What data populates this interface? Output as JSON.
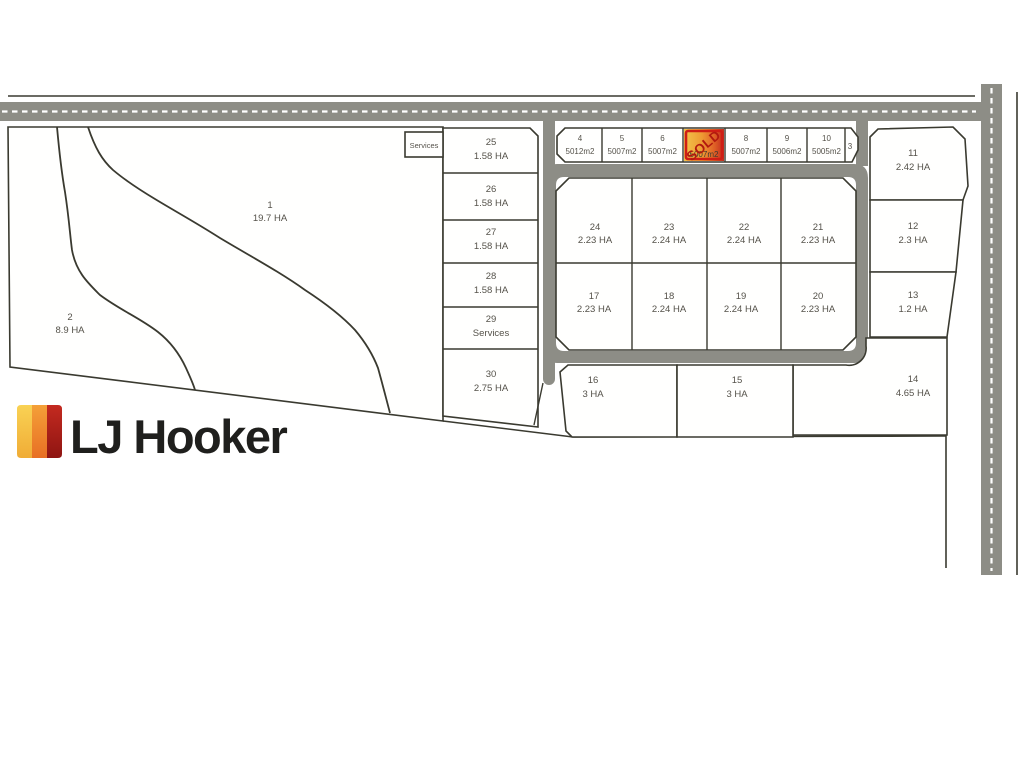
{
  "plan": {
    "title_context": "LJ Hooker land subdivision plan",
    "logo": {
      "text": "LJ Hooker"
    },
    "services_box_label": "Services",
    "sold_label": "SOLD",
    "colors": {
      "road": "#8d8d86",
      "lot_outline": "#3a3a30",
      "label_text": "#55524a",
      "sold_border": "#cf1d15",
      "sold_text": "#b2190f",
      "sold_gradient": [
        "#f2c44a",
        "#ee9a33",
        "#e06226",
        "#c22b1d"
      ],
      "logo_stripes": [
        "#f8c94b",
        "#f09130",
        "#b5211b"
      ],
      "logo_text": "#1f1f1d"
    },
    "lots": {
      "l1": {
        "num": "1",
        "area": "19.7 HA"
      },
      "l2": {
        "num": "2",
        "area": "8.9 HA"
      },
      "l3": {
        "num": "3",
        "area": ""
      },
      "l4": {
        "num": "4",
        "area": "5012m2"
      },
      "l5": {
        "num": "5",
        "area": "5007m2"
      },
      "l6": {
        "num": "6",
        "area": "5007m2"
      },
      "l7": {
        "num": "7",
        "area": "5007m2",
        "status": "SOLD"
      },
      "l8": {
        "num": "8",
        "area": "5007m2"
      },
      "l9": {
        "num": "9",
        "area": "5006m2"
      },
      "l10": {
        "num": "10",
        "area": "5005m2"
      },
      "l11": {
        "num": "11",
        "area": "2.42 HA"
      },
      "l12": {
        "num": "12",
        "area": "2.3 HA"
      },
      "l13": {
        "num": "13",
        "area": "1.2 HA"
      },
      "l14": {
        "num": "14",
        "area": "4.65 HA"
      },
      "l15": {
        "num": "15",
        "area": "3 HA"
      },
      "l16": {
        "num": "16",
        "area": "3 HA"
      },
      "l17": {
        "num": "17",
        "area": "2.23 HA"
      },
      "l18": {
        "num": "18",
        "area": "2.24 HA"
      },
      "l19": {
        "num": "19",
        "area": "2.24 HA"
      },
      "l20": {
        "num": "20",
        "area": "2.23 HA"
      },
      "l21": {
        "num": "21",
        "area": "2.23 HA"
      },
      "l22": {
        "num": "22",
        "area": "2.24 HA"
      },
      "l23": {
        "num": "23",
        "area": "2.24 HA"
      },
      "l24": {
        "num": "24",
        "area": "2.23 HA"
      },
      "l25": {
        "num": "25",
        "area": "1.58 HA"
      },
      "l26": {
        "num": "26",
        "area": "1.58 HA"
      },
      "l27": {
        "num": "27",
        "area": "1.58 HA"
      },
      "l28": {
        "num": "28",
        "area": "1.58 HA"
      },
      "l29": {
        "num": "29",
        "area": "Services"
      },
      "l30": {
        "num": "30",
        "area": "2.75 HA"
      }
    }
  }
}
